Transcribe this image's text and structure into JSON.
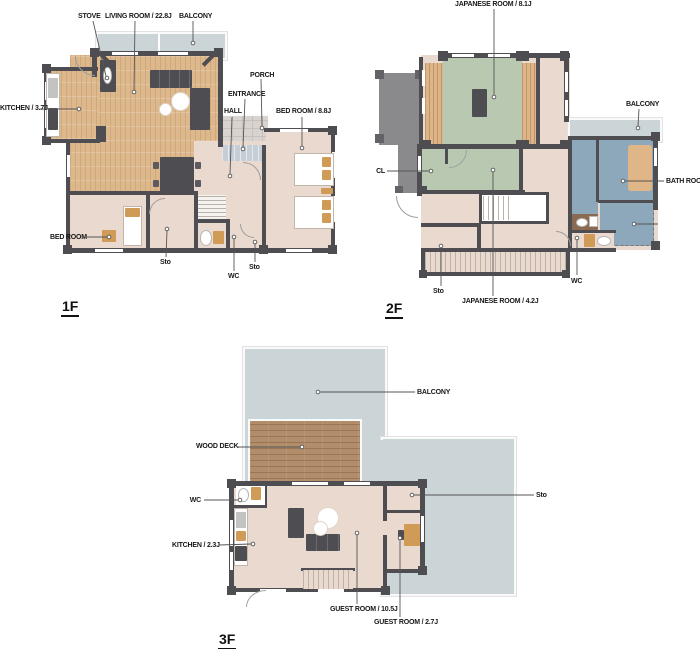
{
  "colors": {
    "wall": "#4d4d52",
    "room": "#e9d9ce",
    "wood": "#ddb88d",
    "tatami": "#b9c9b1",
    "bath": "#8ea8bb",
    "balcony": "#cbd4d7",
    "deck": "#b28d6c",
    "gray": "#8a8a8d",
    "grayblock": "#636367",
    "tan": "#cf9b57",
    "leader": "#555555",
    "text": "#181818"
  },
  "floors": [
    {
      "title": "1F",
      "labels": {
        "stove": "STOVE",
        "living_room": "LIVING ROOM / 22.8J",
        "balcony": "BALCONY",
        "kitchen": "KITCHEN / 3.7J",
        "porch": "PORCH",
        "entrance": "ENTRANCE",
        "hall": "HALL",
        "bed_room_88": "BED ROOM / 8.8J",
        "bed_room": "BED ROOM",
        "sto_left": "Sto",
        "wc": "WC",
        "sto_right": "Sto"
      }
    },
    {
      "title": "2F",
      "labels": {
        "japanese_room_81": "JAPANESE ROOM / 8.1J",
        "balcony": "BALCONY",
        "cl": "CL",
        "bath_room": "BATH ROOM",
        "sto": "Sto",
        "japanese_room_42": "JAPANESE ROOM / 4.2J",
        "wc": "WC"
      }
    },
    {
      "title": "3F",
      "labels": {
        "balcony": "BALCONY",
        "wood_deck": "WOOD DECK",
        "wc": "WC",
        "kitchen": "KITCHEN / 2.3J",
        "guest_room_105": "GUEST ROOM / 10.5J",
        "guest_room_27": "GUEST ROOM / 2.7J",
        "sto": "Sto"
      }
    }
  ]
}
